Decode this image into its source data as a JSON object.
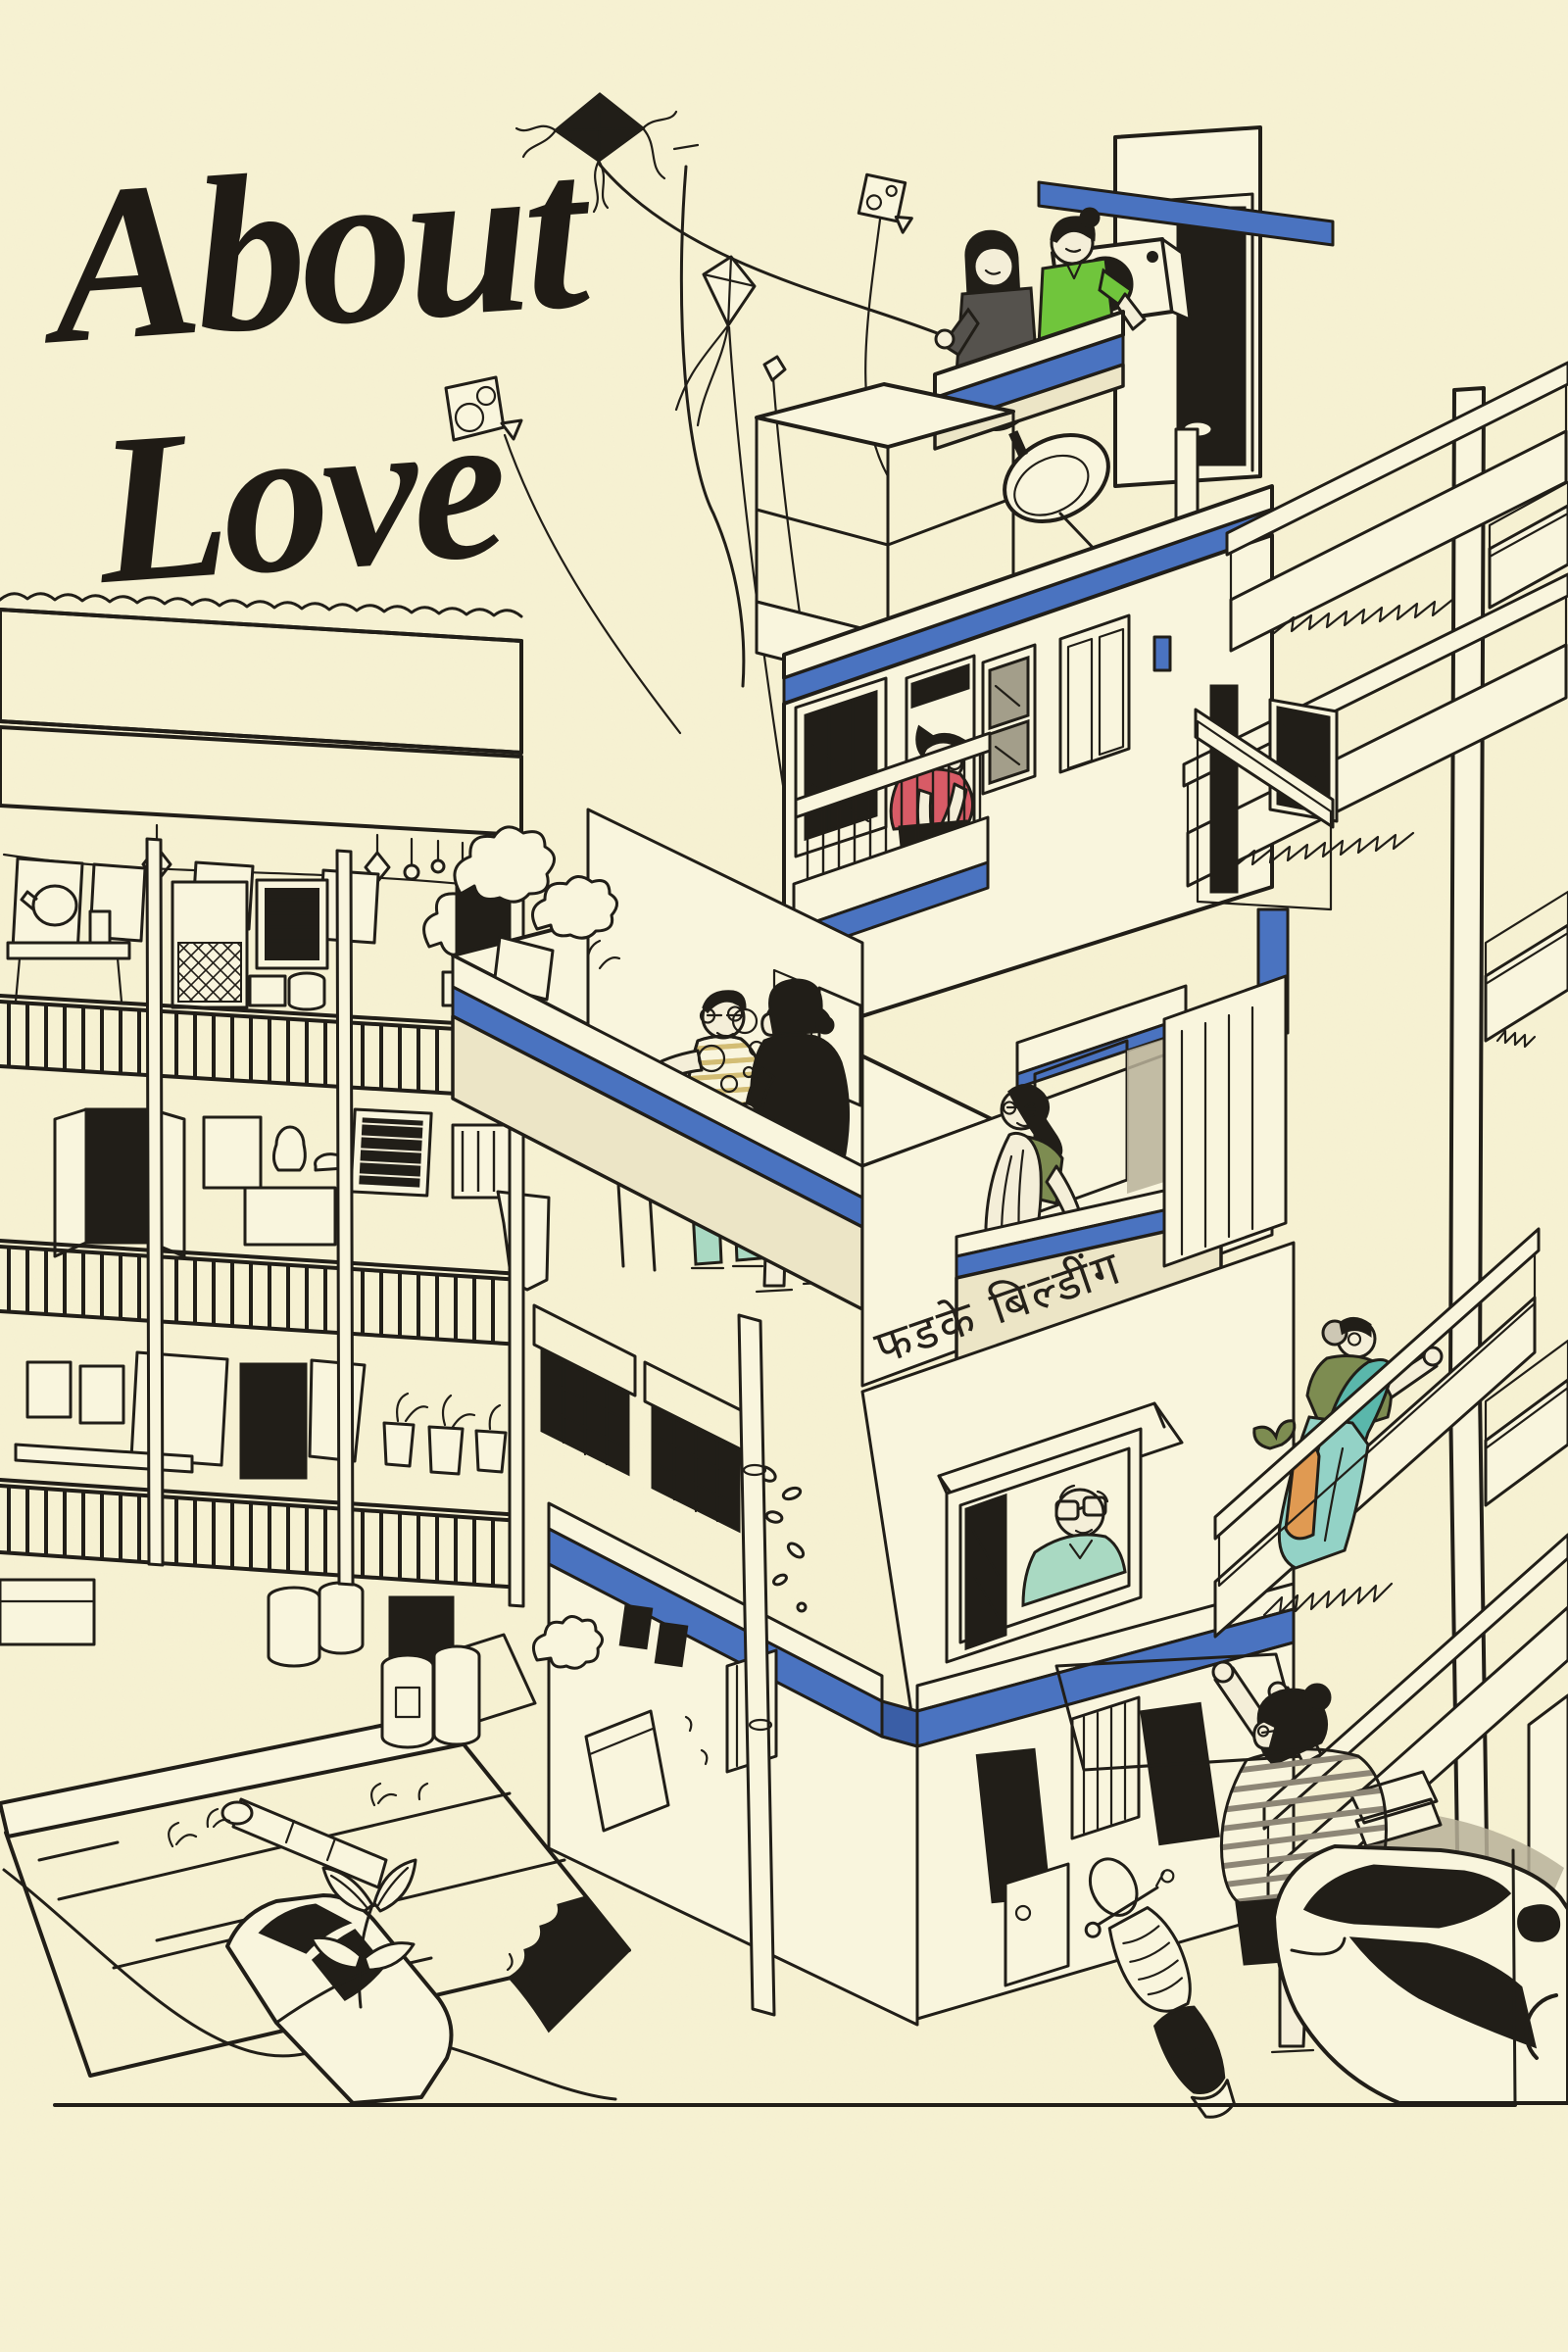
{
  "meta": {
    "kind": "illustrated-poster",
    "orientation": "portrait"
  },
  "title": {
    "line1": "About",
    "line2": "Love"
  },
  "building_sign": {
    "text": "फडके बिल्डींग"
  },
  "palette": {
    "bg": "#f7f2d3",
    "ink": "#211e18",
    "paper": "#f9f5dd",
    "paperShade": "#ece5c6",
    "blue": "#4a73c0",
    "blueDark": "#3a5ea6",
    "green": "#70c53c",
    "gray": "#55524d",
    "red": "#d85b66",
    "teal": "#5ab7ab",
    "tealLight": "#93d2c6",
    "olive": "#7d8c51",
    "yellow": "#e8c52f",
    "orange": "#e09a52",
    "mint": "#a9d9c2",
    "skin": "#f4eed8",
    "glass": "#a39e8a",
    "shadow": "#b9b19a",
    "stripe": "#d3bd74",
    "hairGray": "#cdc7b4"
  },
  "scene": {
    "elements": [
      "brush-script-title",
      "paper-kites",
      "kite-strings",
      "rooftop-couple-flying-kite",
      "air-conditioner",
      "satellite-dish",
      "stair-bulkhead-cage",
      "woman-red-tshirt-leaning-on-balcony",
      "terrace-grandfather-striped-shirt",
      "kid-blowing-bubbles",
      "balcony-woman-looking-up",
      "devanagari-building-sign",
      "old-man-at-window",
      "external-staircase",
      "sari-woman-climbing-stairs",
      "woman-reaching-up-striped-tee",
      "chawl-balconies-with-laundry",
      "clay-tiled-roof",
      "corrugated-shed",
      "white-van",
      "white-car",
      "scooter",
      "barrels",
      "drain-grates",
      "potted-plants",
      "ground-line"
    ]
  }
}
